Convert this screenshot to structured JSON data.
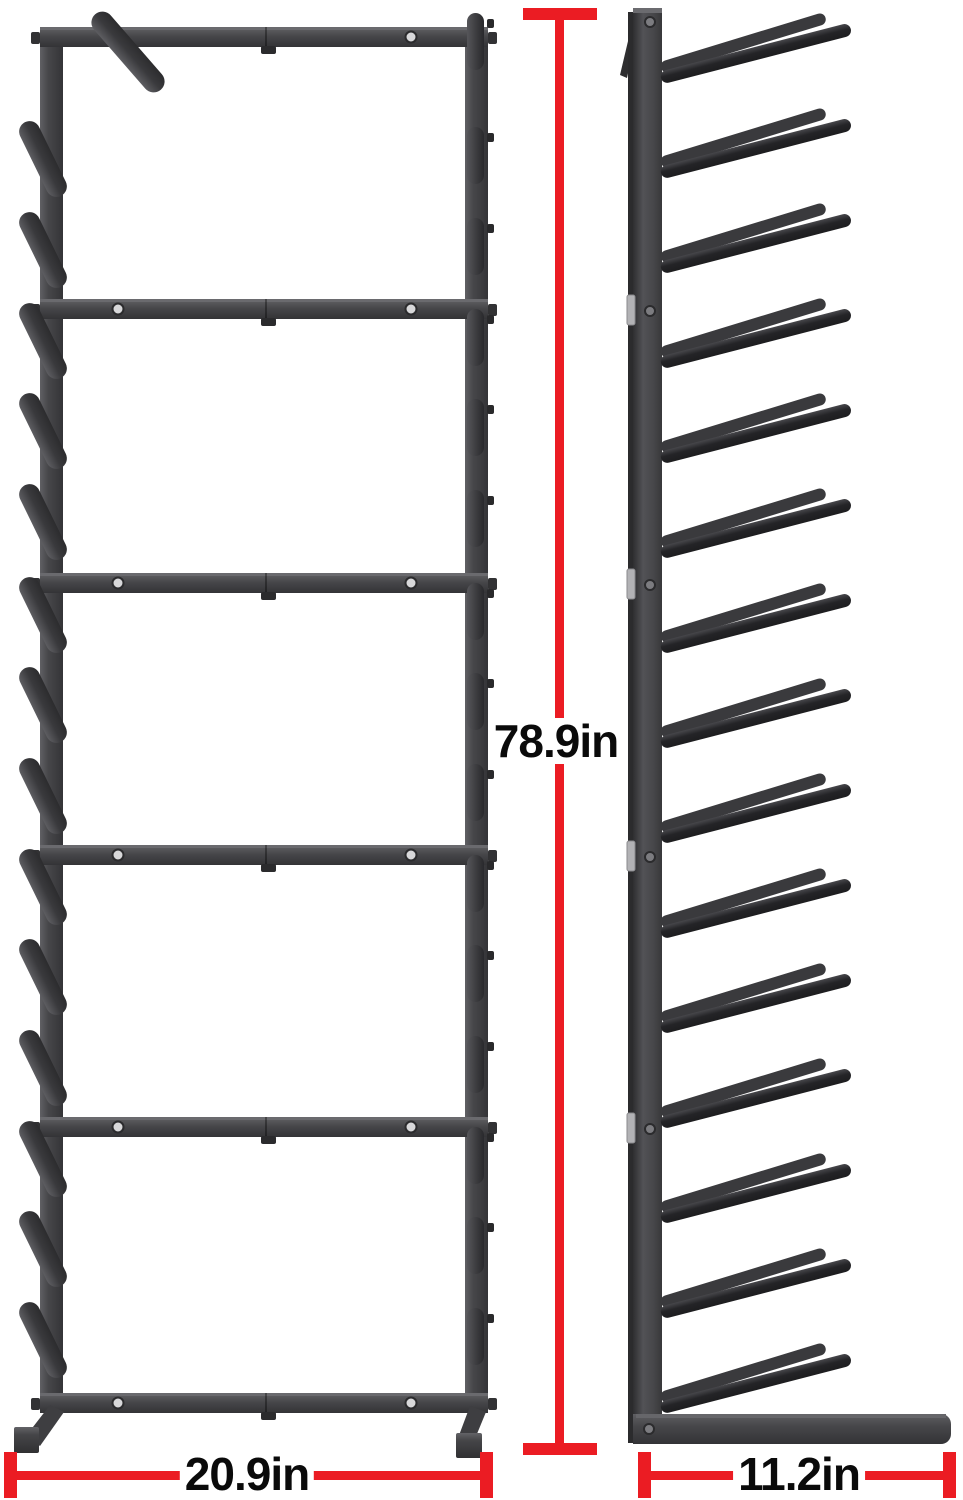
{
  "background": "#ffffff",
  "accent_red": "#eb1c23",
  "text_color": "#0a0a0a",
  "metal": {
    "mid": "#47474a",
    "light": "#636367",
    "dark": "#2b2b2d",
    "peg_front": "#3a3a3d",
    "peg_side": "#242427",
    "connector_silver": "#b2b2b5",
    "screw_hole_fill": "#d8d8da"
  },
  "dimensions": {
    "height": {
      "label": "78.9in",
      "value": 78.9,
      "unit": "in"
    },
    "width": {
      "label": "20.9in",
      "value": 20.9,
      "unit": "in"
    },
    "depth": {
      "label": "11.2in",
      "value": 11.2,
      "unit": "in"
    }
  },
  "views": {
    "front": {
      "name": "front view",
      "crossbars": 6,
      "bays": 5,
      "pegs_per_bay_per_side": 3,
      "screw_holes_per_crossbar": 2
    },
    "side": {
      "name": "side view",
      "peg_levels": 15,
      "joint_connectors": 4
    }
  }
}
